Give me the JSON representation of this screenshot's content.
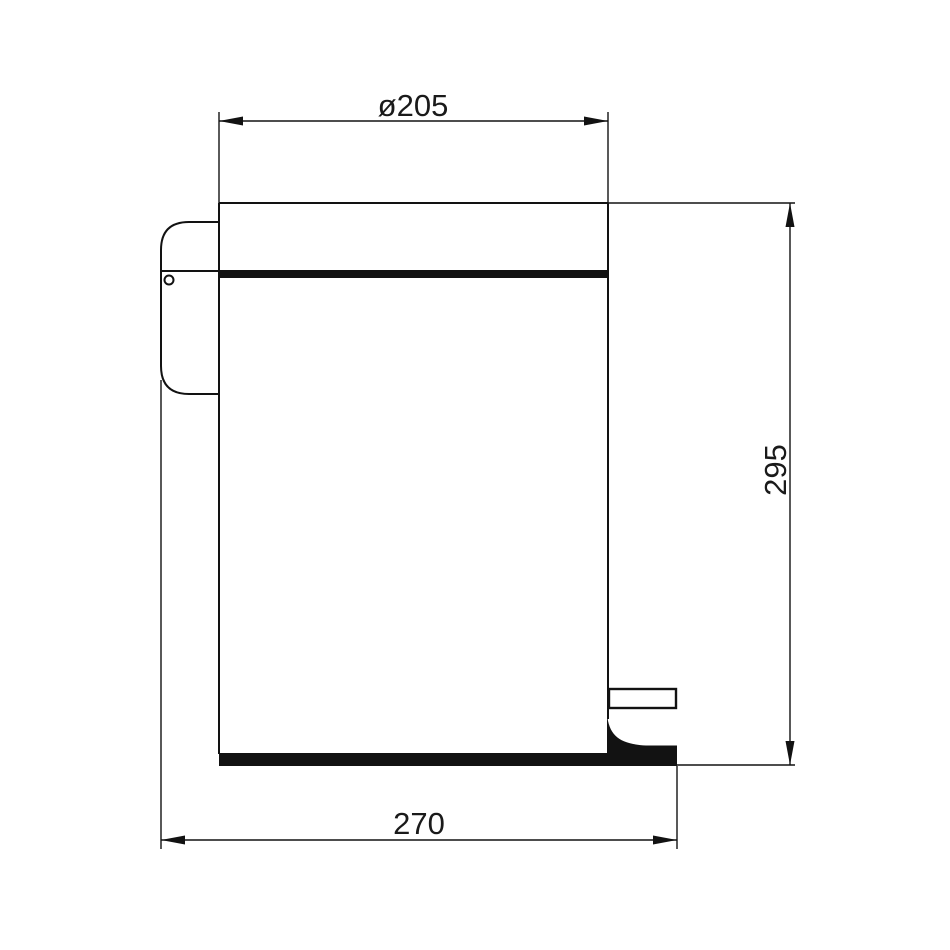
{
  "page": {
    "background_color": "#ffffff",
    "line_color": "#121212"
  },
  "drawing": {
    "subject": "pedal bin side view technical drawing",
    "dimensions": {
      "lid_diameter": {
        "label": "ø205",
        "value": 205
      },
      "body_height": {
        "label": "295",
        "value": 295
      },
      "base_depth": {
        "label": "270",
        "value": 270
      }
    }
  }
}
